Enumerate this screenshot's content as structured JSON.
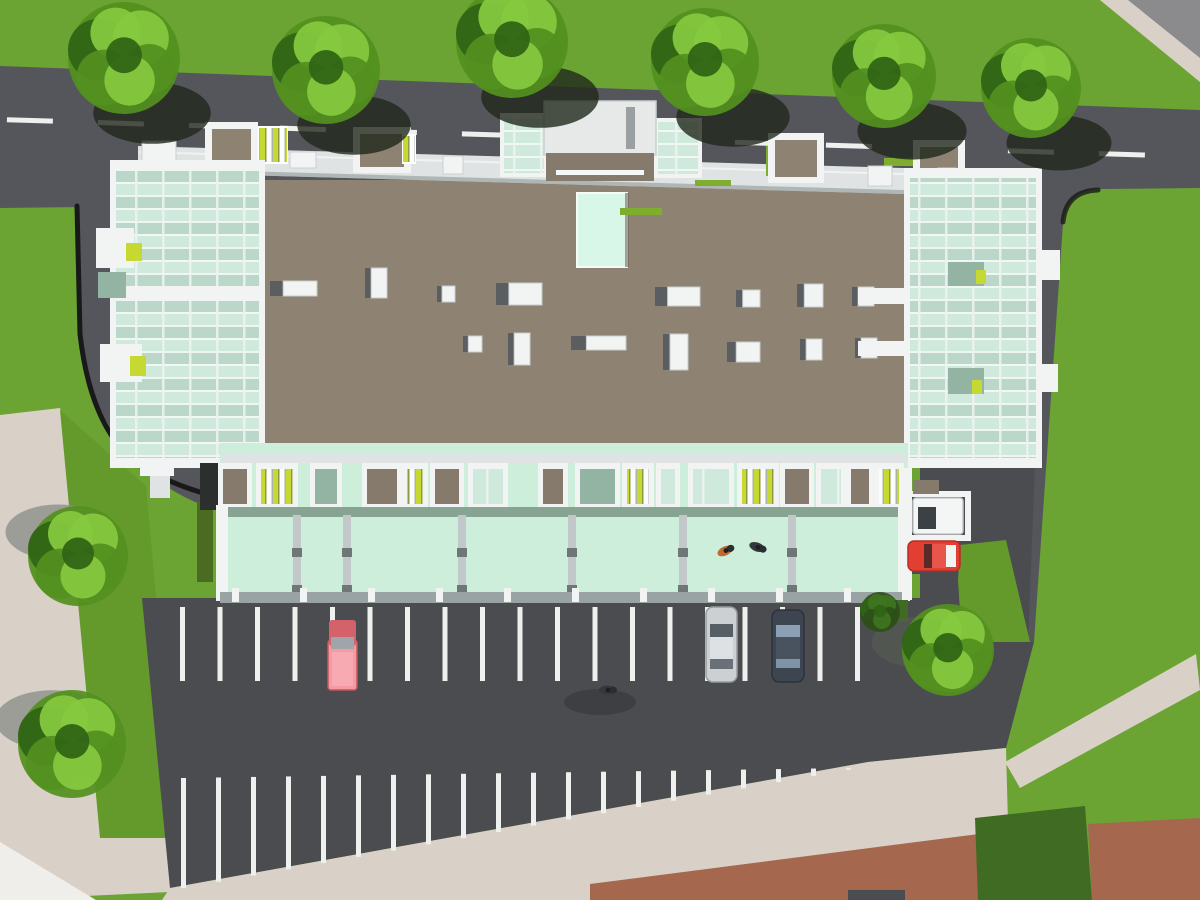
{
  "meta": {
    "title": "Aerial 3D architectural site render",
    "description": "Top-down rendering of a long mixed-use building with glass atrium ends, rooftop units, street-side balconies, a mint entrance canopy, street with dashed line, striped parking lot, cars and trees",
    "canvas": {
      "width": 1200,
      "height": 900
    }
  },
  "colors": {
    "grass": "#6ba433",
    "grassOlive": "#649a2c",
    "grassDark": "#3f6b22",
    "road": "#55565b",
    "lot": "#4b4c50",
    "roadLine": "#eef0ee",
    "curb": "#191919",
    "sidewalk": "#d9d1c7",
    "sidewalkLight": "#efeeea",
    "terracotta": "#a5674e",
    "grayBuilding": "#8b8b8e",
    "roof": "#8e8272",
    "roofDark": "#857a6b",
    "white": "#f2f4f4",
    "whiteDim": "#dfe3e3",
    "grayLight": "#c2c8c9",
    "grayMid": "#9aa3a3",
    "glassMint": "#cfeadd",
    "glassSage": "#93b3a3",
    "skylight": "#d9f7e9",
    "canopy": "#cdeeda",
    "canopySage": "#7e9b88",
    "accent": "#c6d832",
    "treeMid": "#53901f",
    "treeLight": "#85c93e",
    "treeDark": "#2f6414",
    "treeShadowDark": "#20281c",
    "treeShadowGray": "#8f948d",
    "carPink": "#f49aa3",
    "carPinkDark": "#d4626b",
    "carSilver": "#ccd0d3",
    "carNavy": "#3d4551",
    "carRed": "#e23f33",
    "vanWhite": "#f4f6f6",
    "windshield": "#9fa6ab"
  },
  "scene": {
    "roadDashes": {
      "count": 13,
      "x0": 7,
      "step": 91,
      "len": 46,
      "h": 5,
      "yBase": 117,
      "slope": 0.031
    },
    "stripes": {
      "row1": {
        "x0": 180,
        "step": 37.5,
        "count": 19,
        "yTop": 607,
        "yBot": 681,
        "w": 5
      },
      "row2": {
        "x0": 181,
        "step": 35,
        "count": 20,
        "w": 5,
        "topBase": 778,
        "topSlope": 0.015,
        "botBase": 888,
        "botSlope": 0.178
      }
    },
    "treesTop": [
      [
        124,
        58,
        56
      ],
      [
        326,
        70,
        54
      ],
      [
        512,
        42,
        56
      ],
      [
        705,
        62,
        54
      ],
      [
        884,
        76,
        52
      ],
      [
        1031,
        88,
        50
      ]
    ],
    "treesLeft": [
      [
        78,
        556,
        50
      ],
      [
        72,
        744,
        54
      ]
    ],
    "treesLot": [
      [
        948,
        650,
        46
      ]
    ],
    "bushes": [
      [
        880,
        612,
        20
      ]
    ],
    "roofUnits": [
      [
        270,
        281,
        47,
        15
      ],
      [
        365,
        268,
        22,
        30
      ],
      [
        437,
        286,
        18,
        16
      ],
      [
        496,
        283,
        46,
        22
      ],
      [
        463,
        336,
        19,
        16
      ],
      [
        508,
        333,
        22,
        32
      ],
      [
        571,
        336,
        55,
        14
      ],
      [
        655,
        287,
        45,
        19
      ],
      [
        663,
        334,
        25,
        36
      ],
      [
        736,
        290,
        24,
        17
      ],
      [
        727,
        342,
        33,
        20
      ],
      [
        797,
        284,
        26,
        23
      ],
      [
        800,
        339,
        22,
        21
      ],
      [
        852,
        287,
        22,
        19
      ],
      [
        855,
        338,
        22,
        20
      ]
    ],
    "northUnits": [
      {
        "x": 142,
        "y": 141,
        "w": 34,
        "h": 22,
        "t": "white"
      },
      {
        "x": 205,
        "y": 122,
        "w": 53,
        "h": 44,
        "t": "patio"
      },
      {
        "x": 258,
        "y": 126,
        "w": 30,
        "h": 38,
        "t": "slats"
      },
      {
        "x": 290,
        "y": 152,
        "w": 26,
        "h": 16,
        "t": "white"
      },
      {
        "x": 353,
        "y": 127,
        "w": 58,
        "h": 46,
        "t": "patio"
      },
      {
        "x": 402,
        "y": 134,
        "w": 14,
        "h": 30,
        "t": "slats"
      },
      {
        "x": 443,
        "y": 156,
        "w": 20,
        "h": 18,
        "t": "white"
      },
      {
        "x": 500,
        "y": 113,
        "w": 48,
        "h": 64,
        "t": "glassbox"
      },
      {
        "x": 654,
        "y": 118,
        "w": 48,
        "h": 60,
        "t": "glassbox"
      },
      {
        "x": 768,
        "y": 133,
        "w": 56,
        "h": 50,
        "t": "patio"
      },
      {
        "x": 868,
        "y": 166,
        "w": 24,
        "h": 20,
        "t": "white"
      },
      {
        "x": 913,
        "y": 140,
        "w": 52,
        "h": 46,
        "t": "patio"
      },
      {
        "x": 938,
        "y": 168,
        "w": 18,
        "h": 18,
        "t": "white"
      },
      {
        "x": 1003,
        "y": 172,
        "w": 30,
        "h": 36,
        "t": "white"
      }
    ],
    "planters": [
      [
        884,
        158,
        30,
        8
      ],
      [
        930,
        180,
        26,
        6
      ],
      [
        766,
        146,
        8,
        30
      ],
      [
        620,
        208,
        42,
        7
      ],
      [
        214,
        160,
        30,
        7
      ],
      [
        695,
        180,
        36,
        6
      ]
    ],
    "southModules": [
      [
        200,
        18,
        "dark"
      ],
      [
        218,
        34,
        "patio"
      ],
      [
        256,
        42,
        "slats"
      ],
      [
        310,
        32,
        "sage"
      ],
      [
        362,
        40,
        "patio"
      ],
      [
        402,
        26,
        "slats"
      ],
      [
        430,
        34,
        "patio"
      ],
      [
        468,
        40,
        "glass"
      ],
      [
        538,
        30,
        "patio"
      ],
      [
        575,
        45,
        "sage"
      ],
      [
        622,
        32,
        "slats"
      ],
      [
        656,
        24,
        "glass"
      ],
      [
        688,
        46,
        "glass"
      ],
      [
        737,
        42,
        "slats"
      ],
      [
        780,
        34,
        "patio"
      ],
      [
        816,
        30,
        "glass"
      ],
      [
        846,
        28,
        "patio"
      ],
      [
        874,
        30,
        "slats"
      ]
    ],
    "canopyBeams": [
      297,
      347,
      462,
      572,
      683,
      792
    ],
    "canopyPosts": {
      "x0": 232,
      "step": 68,
      "count": 10,
      "w": 7,
      "h": 14,
      "y": 588
    },
    "vehicles": {
      "pickup": {
        "x": 328,
        "y": 620
      },
      "silver": {
        "x": 706,
        "y": 607
      },
      "navy": {
        "x": 772,
        "y": 610
      },
      "red": {
        "x": 908,
        "y": 541
      },
      "van": {
        "x": 913,
        "y": 498
      }
    },
    "people": [
      [
        725,
        551,
        -25,
        "orange"
      ],
      [
        757,
        547,
        20,
        "dark"
      ],
      [
        607,
        690,
        0,
        "dark"
      ]
    ]
  }
}
